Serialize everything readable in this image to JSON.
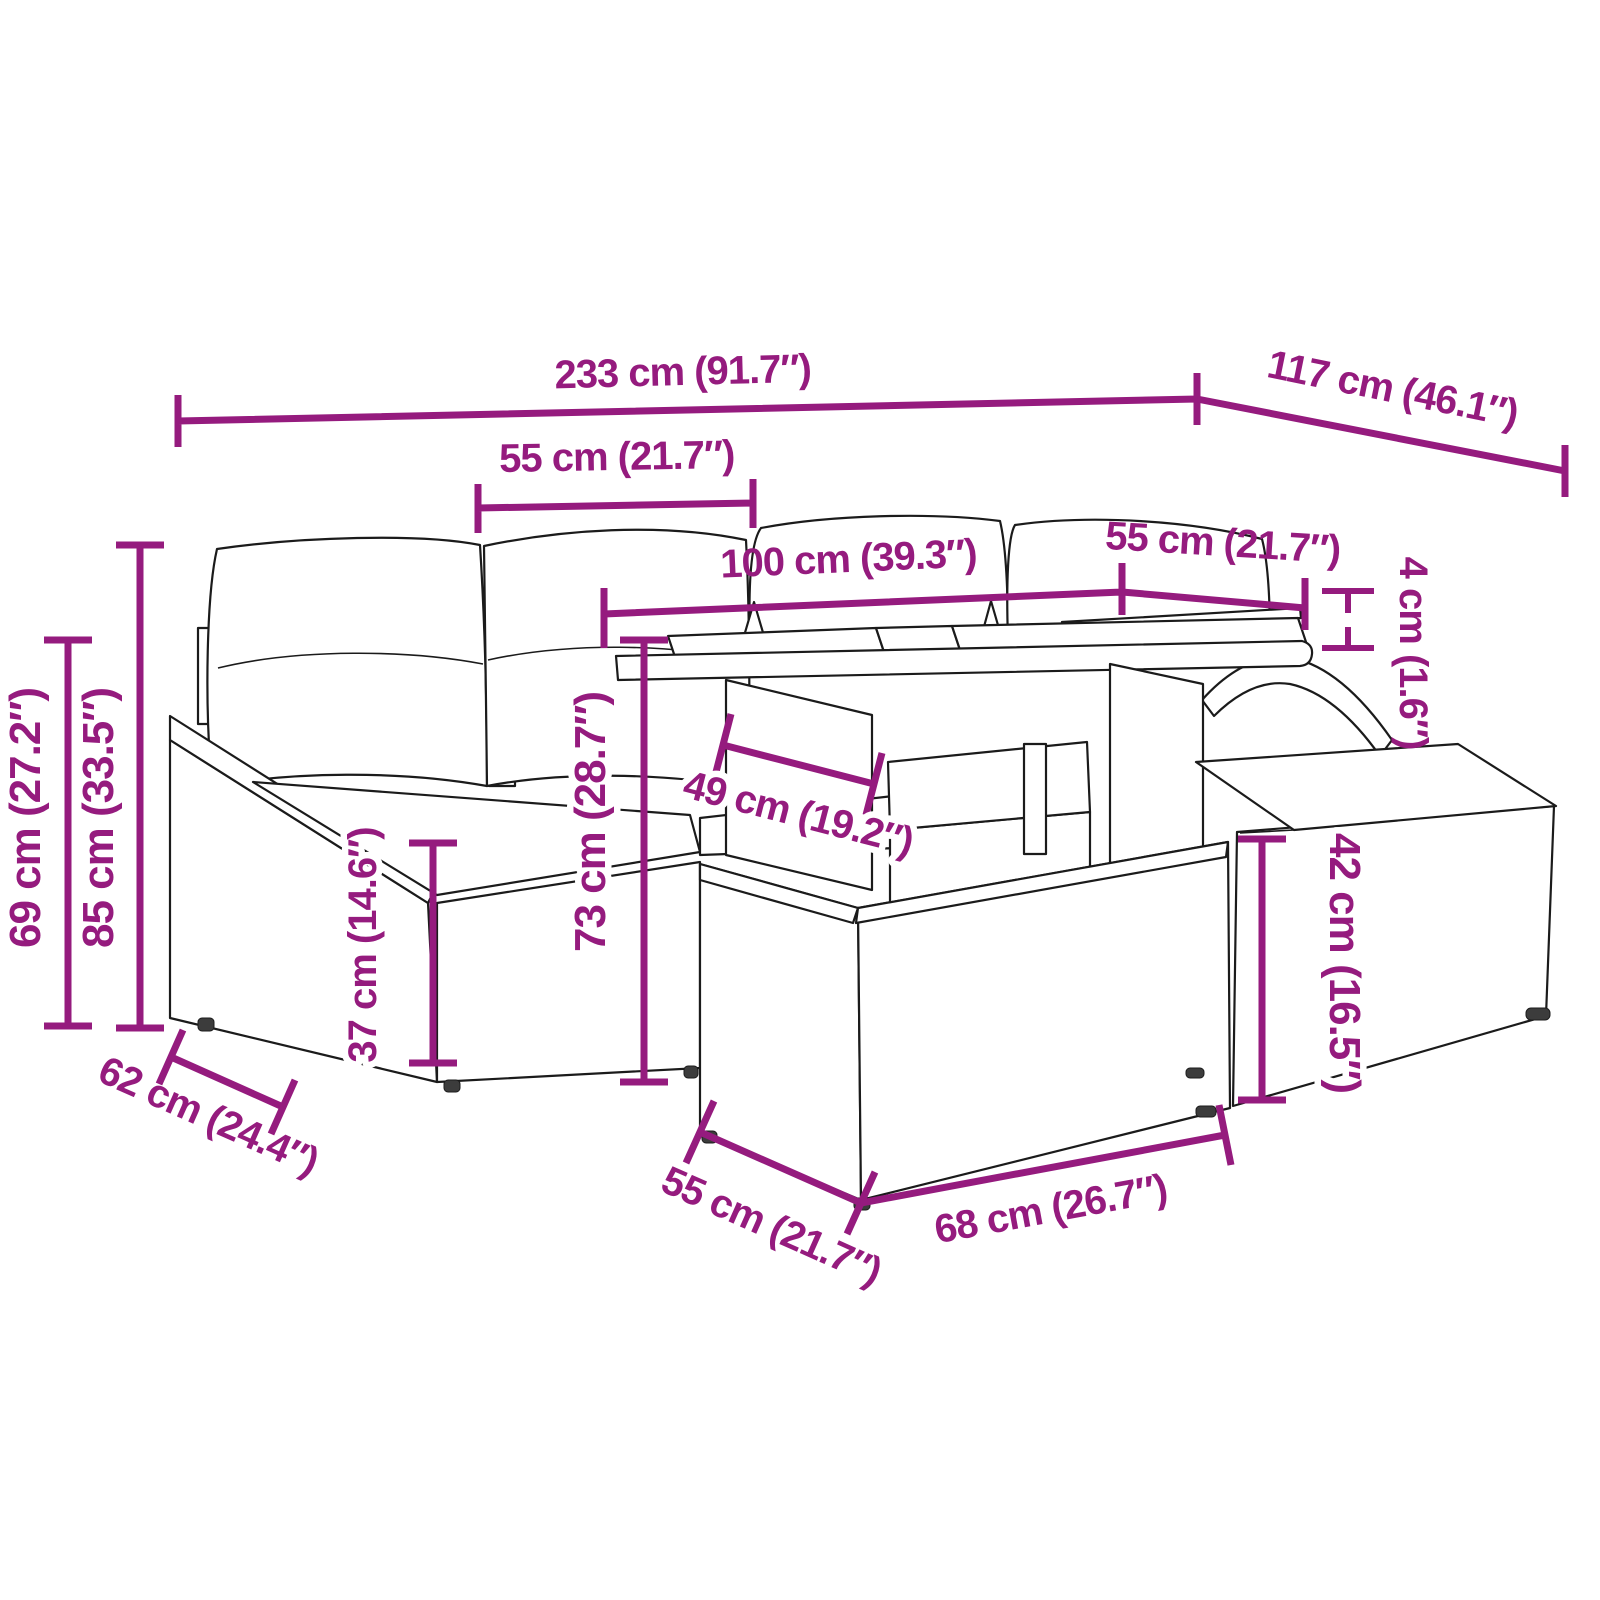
{
  "diagram": {
    "type": "product-dimension-diagram",
    "accent_color": "#951B7E",
    "line_color": "#1b1b1b",
    "glass_color": "#c6cbc6",
    "labels": {
      "overall_width": "233 cm (91.7″)",
      "overall_depth": "117 cm (46.1″)",
      "seat_width_top": "55 cm (21.7″)",
      "table_length": "100 cm (39.3″)",
      "stool_width_right": "55 cm (21.7″)",
      "tabletop_thickness": "4 cm (1.6″)",
      "back_height": "85 cm (33.5″)",
      "arm_height": "69 cm (27.2″)",
      "table_support_width": "49 cm (19.2″)",
      "seat_height": "37 cm (14.6″)",
      "table_height": "73 cm (28.7″)",
      "stool_height": "42 cm (16.5″)",
      "seat_depth": "62 cm (24.4″)",
      "stool_depth_bottom": "55 cm (21.7″)",
      "stool_width_bottom": "68 cm (26.7″)"
    }
  }
}
